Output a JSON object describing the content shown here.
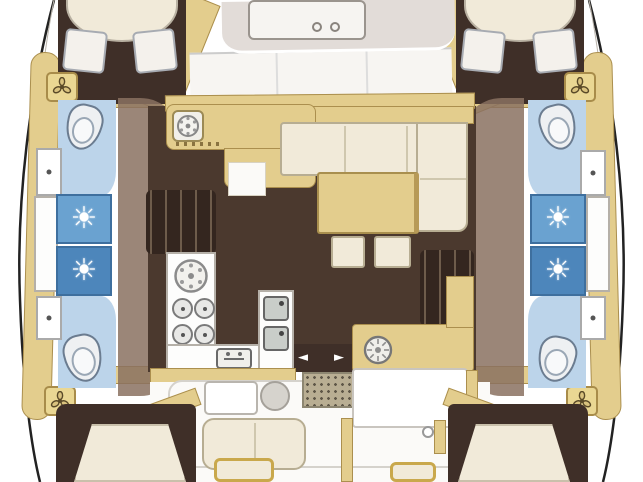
{
  "plan": {
    "icons": {
      "shower": "☀",
      "door_arrow_left": "◄",
      "door_arrow_right": "►"
    },
    "colors": {
      "deck_tan": "#e3cd8d",
      "trim": "#ab8f4e",
      "floor_brown": "#4b392e",
      "cabin_brown": "#3f2f28",
      "shadow_brown": "#8a7160",
      "cream": "#f1ead9",
      "cream_border": "#b7ad92",
      "head_blue": "#bcd4ea",
      "shower_blue": "#6aa2d0",
      "shower_blue_dark": "#4d86bb",
      "coachroof_gray": "#e2dcd8",
      "grate": "#b9ae93",
      "outline": "#222222"
    }
  }
}
